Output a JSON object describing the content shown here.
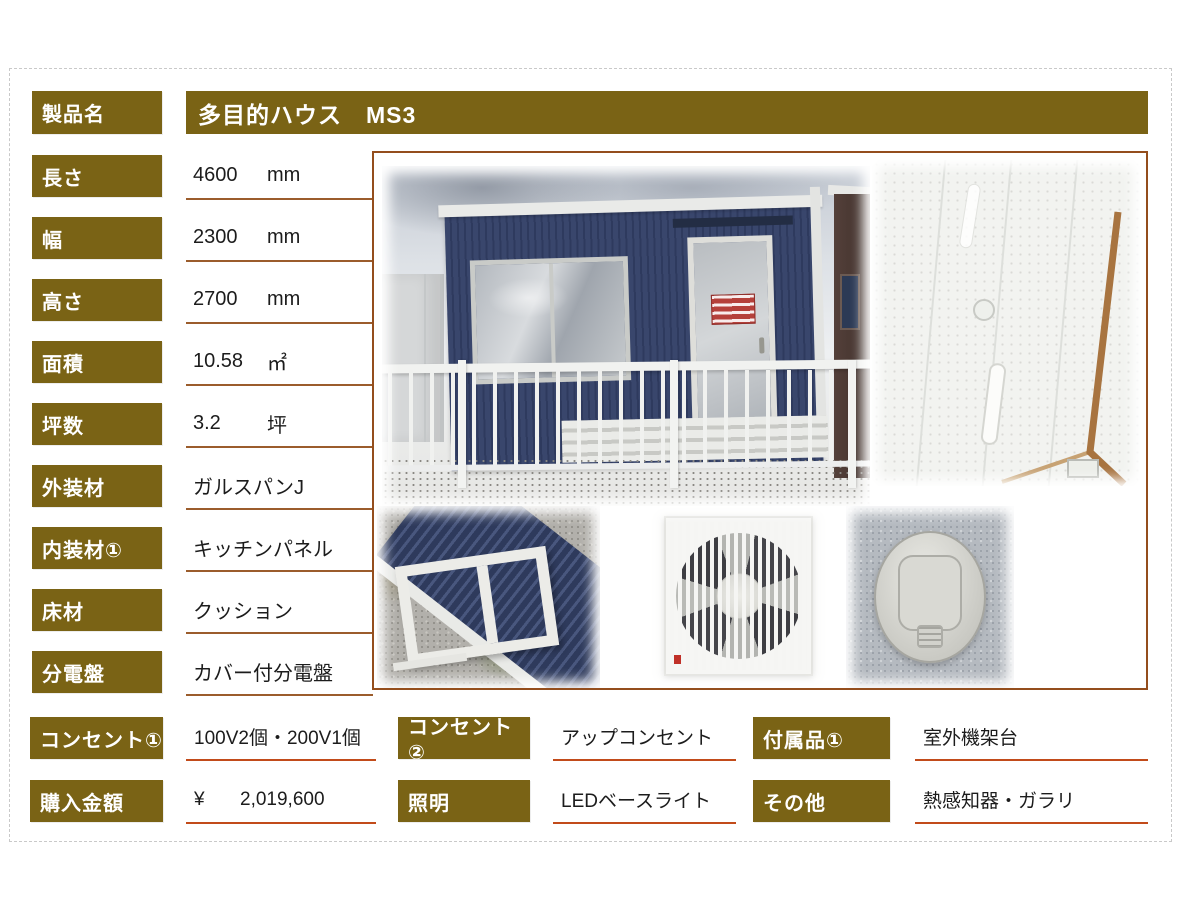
{
  "sheet": {
    "product_label": "製品名",
    "product_name": "多目的ハウス　MS3"
  },
  "specs": [
    {
      "label": "長さ",
      "value": "4600",
      "unit": "mm"
    },
    {
      "label": "幅",
      "value": "2300",
      "unit": "mm"
    },
    {
      "label": "高さ",
      "value": "2700",
      "unit": "mm"
    },
    {
      "label": "面積",
      "value": "10.58",
      "unit": "㎡"
    },
    {
      "label": "坪数",
      "value": "3.2",
      "unit": "坪"
    },
    {
      "label": "外装材",
      "value": "ガルスパンJ",
      "unit": ""
    },
    {
      "label": "内装材①",
      "value": "キッチンパネル",
      "unit": ""
    },
    {
      "label": "床材",
      "value": "クッション",
      "unit": ""
    },
    {
      "label": "分電盤",
      "value": "カバー付分電盤",
      "unit": ""
    }
  ],
  "details": {
    "rows": [
      {
        "cells": [
          {
            "label": "コンセント①",
            "prefix": "",
            "value": "100V2個・200V1個"
          },
          {
            "label": "コンセント②",
            "prefix": "",
            "value": "アップコンセント"
          },
          {
            "label": "付属品①",
            "prefix": "",
            "value": "室外機架台"
          }
        ]
      },
      {
        "cells": [
          {
            "label": "購入金額",
            "prefix": "¥",
            "value": "2,019,600"
          },
          {
            "label": "照明",
            "prefix": "",
            "value": "LEDベースライト"
          },
          {
            "label": "その他",
            "prefix": "",
            "value": "熱感知器・ガラリ"
          }
        ]
      }
    ]
  },
  "colors": {
    "label_bg": "#7a6315",
    "label_text": "#ffffff",
    "value_text": "#1c1c1c",
    "spec_underline": "#9b5c2c",
    "detail_underline": "#c24b1a",
    "photo_frame_border": "#944e1d"
  }
}
